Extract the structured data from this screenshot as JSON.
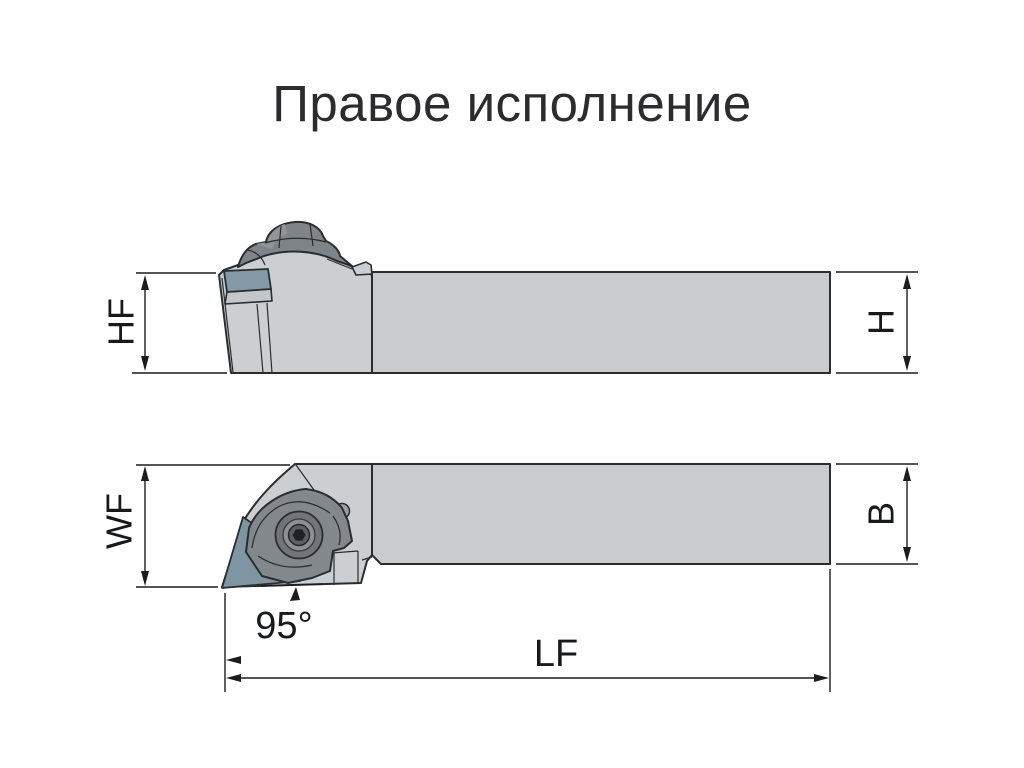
{
  "title": "Правое исполнение",
  "drawing": {
    "side_view": {
      "dim_height_head": "HF",
      "dim_height_shank": "H"
    },
    "top_view": {
      "dim_width_head": "WF",
      "dim_width_shank": "B",
      "dim_length": "LF",
      "dim_angle": "95°"
    }
  },
  "colors": {
    "background": "#ffffff",
    "outline": "#2a2d2f",
    "body_fill": "#cbced0",
    "insert_fill": "#8399a5",
    "clamp_fill": "#7f8488",
    "dimension_lines": "#1c1c1c",
    "title_text": "#2c2c2e"
  }
}
